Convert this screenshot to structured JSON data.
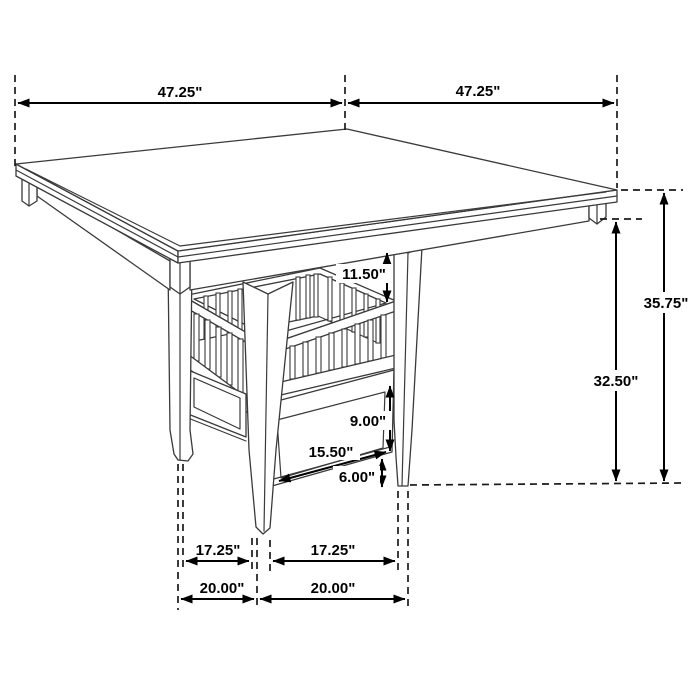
{
  "diagram": {
    "kind": "furniture-dimension-drawing",
    "subject": "Square counter-height dining table with pedestal storage base (slatted shelf and drawer)",
    "units": "inches",
    "background_color": "#ffffff",
    "dimension_color": "#000000",
    "drawing_line_color": "#3a3a3a",
    "dims": {
      "top_width_left": "47.25\"",
      "top_width_right": "47.25\"",
      "overall_height": "35.75\"",
      "floor_to_apron_height": "32.50\"",
      "apron_to_shelf_gap": "11.50\"",
      "drawer_section_height": "9.00\"",
      "drawer_width": "15.50\"",
      "bottom_clearance": "6.00\"",
      "feet_inner_span_left": "17.25\"",
      "feet_inner_span_right": "17.25\"",
      "feet_outer_span_left": "20.00\"",
      "feet_outer_span_right": "20.00\""
    }
  }
}
